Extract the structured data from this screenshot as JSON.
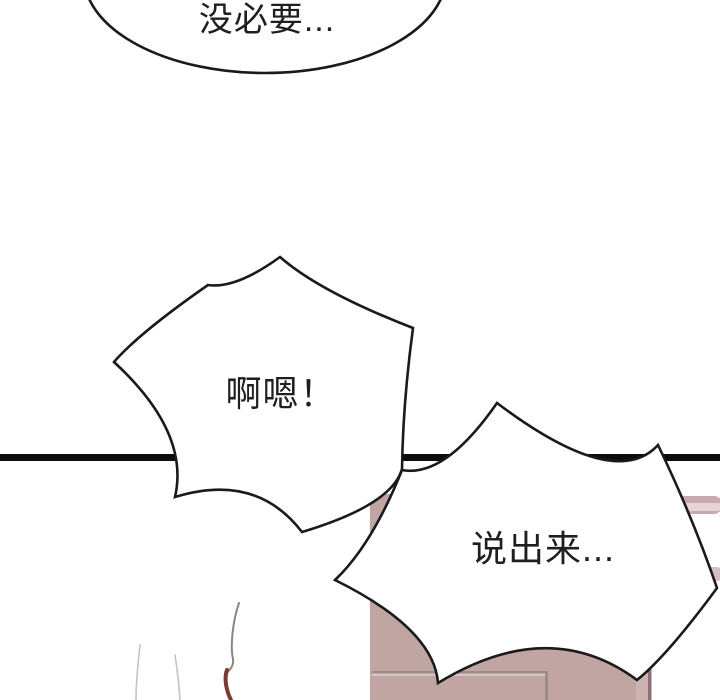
{
  "panel": {
    "type": "comic-panel",
    "background": "#ffffff",
    "outline_color": "#1a1a1a",
    "divider": {
      "color": "#0c0c0c"
    }
  },
  "bubbles": {
    "top": {
      "shape": "ellipse",
      "text": "没必要..."
    },
    "middle": {
      "shape": "burst",
      "text": "啊嗯！"
    },
    "bottom": {
      "shape": "burst",
      "text": "说出来..."
    }
  },
  "scene": {
    "cabinet": {
      "base_color": "#c0a5a3",
      "seam_dark": "#9c8b89",
      "seam_light": "#d8c4c2",
      "edge_band": "#cbb3b1",
      "edge_dark": "#8e7170"
    },
    "wall_streaks": {
      "upper_color": "#c9a9ad",
      "upper_highlight": "#e8d4d6",
      "lower_color": "#d5bfbf"
    },
    "hair": {
      "faint_color": "#c6c2c0",
      "strand_color": "#8a8684",
      "brown_color": "#7a3b30"
    }
  }
}
